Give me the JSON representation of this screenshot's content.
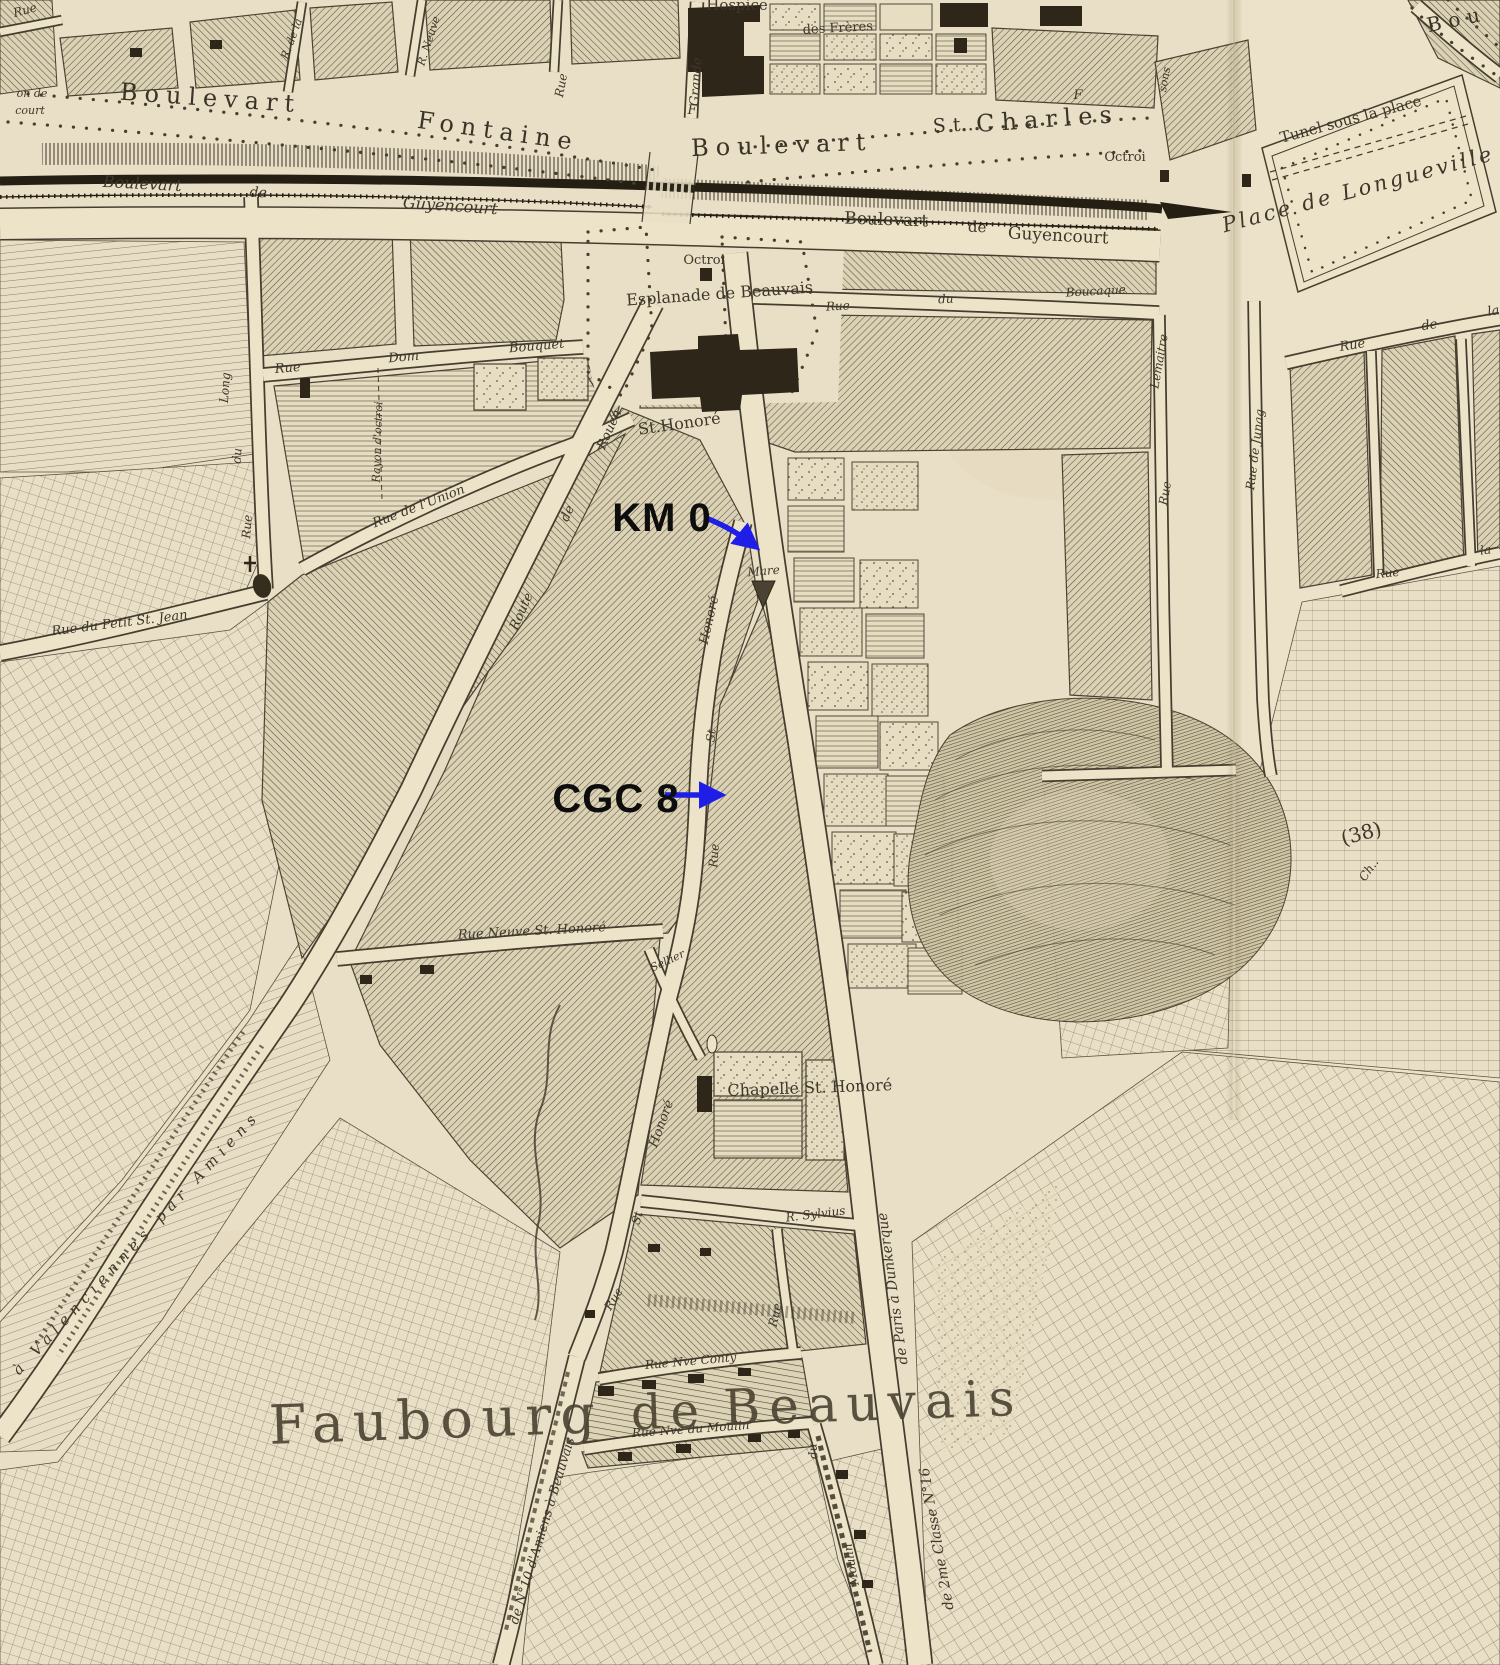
{
  "map": {
    "paper_color": "#e9dfc6",
    "road_color": "#ece3c9",
    "ink_color": "#3e372a",
    "labels": [
      {
        "t": "Boulevart",
        "x": 210,
        "y": 106,
        "r": 4,
        "s": 24,
        "c": "bd"
      },
      {
        "t": "Fontaine",
        "x": 497,
        "y": 139,
        "r": 8,
        "s": 24,
        "c": "bd"
      },
      {
        "t": "Boulevart",
        "x": 782,
        "y": 153,
        "r": -2,
        "s": 24,
        "c": "bd"
      },
      {
        "t": "St.",
        "x": 957,
        "y": 131,
        "r": -3,
        "s": 19,
        "c": "bd"
      },
      {
        "t": "Charles",
        "x": 1048,
        "y": 127,
        "r": -4,
        "s": 24,
        "c": "bd"
      },
      {
        "t": "Boulevart",
        "x": 142,
        "y": 189,
        "r": 3,
        "s": 16
      },
      {
        "t": "de",
        "x": 258,
        "y": 197,
        "r": 3,
        "s": 14
      },
      {
        "t": "Guyencourt",
        "x": 450,
        "y": 211,
        "r": 4,
        "s": 16
      },
      {
        "t": "Boulevart",
        "x": 886,
        "y": 225,
        "r": 2,
        "s": 17,
        "c": "sr"
      },
      {
        "t": "de",
        "x": 977,
        "y": 232,
        "r": 2,
        "s": 15,
        "c": "sr"
      },
      {
        "t": "Guyencourt",
        "x": 1058,
        "y": 241,
        "r": 3,
        "s": 17,
        "c": "sr"
      },
      {
        "t": "Hospice",
        "x": 737,
        "y": 10,
        "r": 0,
        "s": 15,
        "c": "sr"
      },
      {
        "t": "des Frères",
        "x": 838,
        "y": 32,
        "r": -3,
        "s": 13,
        "c": "sr"
      },
      {
        "t": "Grande",
        "x": 700,
        "y": 82,
        "r": -86,
        "s": 13
      },
      {
        "t": "Rue",
        "x": 565,
        "y": 86,
        "r": -80,
        "s": 12
      },
      {
        "t": "R. Neuve",
        "x": 432,
        "y": 42,
        "r": -72,
        "s": 11
      },
      {
        "t": "R. de la",
        "x": 295,
        "y": 40,
        "r": -70,
        "s": 11
      },
      {
        "t": "Rue",
        "x": 26,
        "y": 14,
        "r": -15,
        "s": 12
      },
      {
        "t": "on de",
        "x": 32,
        "y": 97,
        "r": 0,
        "s": 11
      },
      {
        "t": "court",
        "x": 30,
        "y": 114,
        "r": 0,
        "s": 11
      },
      {
        "t": "F",
        "x": 692,
        "y": 114,
        "r": 0,
        "s": 13
      },
      {
        "t": "F",
        "x": 1078,
        "y": 99,
        "r": 0,
        "s": 13
      },
      {
        "t": "Octroi",
        "x": 1125,
        "y": 161,
        "r": 0,
        "s": 13,
        "c": "sr"
      },
      {
        "t": "Tunel sous la place",
        "x": 1352,
        "y": 124,
        "r": -15,
        "s": 15,
        "c": "sr"
      },
      {
        "t": "Place de Longueville",
        "x": 1360,
        "y": 196,
        "r": -15,
        "s": 21,
        "c": "pl"
      },
      {
        "t": "Bou",
        "x": 1458,
        "y": 26,
        "r": -12,
        "s": 20,
        "c": "bd"
      },
      {
        "t": "Rue",
        "x": 1353,
        "y": 349,
        "r": -9,
        "s": 13
      },
      {
        "t": "de",
        "x": 1430,
        "y": 329,
        "r": -9,
        "s": 13
      },
      {
        "t": "la",
        "x": 1494,
        "y": 315,
        "r": -9,
        "s": 13
      },
      {
        "t": "Octroi",
        "x": 704,
        "y": 264,
        "r": 0,
        "s": 13,
        "c": "sr"
      },
      {
        "t": "Esplanade de Beauvais",
        "x": 720,
        "y": 299,
        "r": -4,
        "s": 16,
        "c": "sr"
      },
      {
        "t": "St.Honoré",
        "x": 680,
        "y": 429,
        "r": -8,
        "s": 16,
        "c": "sr"
      },
      {
        "t": "Rue",
        "x": 838,
        "y": 310,
        "r": -3,
        "s": 12
      },
      {
        "t": "du",
        "x": 946,
        "y": 303,
        "r": -3,
        "s": 12
      },
      {
        "t": "Boucaque",
        "x": 1096,
        "y": 295,
        "r": -3,
        "s": 12
      },
      {
        "t": "Lemaitre",
        "x": 1163,
        "y": 362,
        "r": -80,
        "s": 12
      },
      {
        "t": "Rue",
        "x": 1169,
        "y": 494,
        "r": -80,
        "s": 12
      },
      {
        "t": "Rue de Junag",
        "x": 1259,
        "y": 450,
        "r": -83,
        "s": 12
      },
      {
        "t": "Rue",
        "x": 1388,
        "y": 577,
        "r": -6,
        "s": 12
      },
      {
        "t": "la",
        "x": 1486,
        "y": 554,
        "r": -6,
        "s": 12
      },
      {
        "t": "sons",
        "x": 1168,
        "y": 80,
        "r": -80,
        "s": 11
      },
      {
        "t": "Mare",
        "x": 764,
        "y": 575,
        "r": -5,
        "s": 12
      },
      {
        "t": "Honoré",
        "x": 713,
        "y": 621,
        "r": -77,
        "s": 13
      },
      {
        "t": "St",
        "x": 715,
        "y": 736,
        "r": -84,
        "s": 12
      },
      {
        "t": "Rue",
        "x": 718,
        "y": 856,
        "r": -86,
        "s": 12
      },
      {
        "t": "Rouen",
        "x": 613,
        "y": 431,
        "r": -66,
        "s": 13
      },
      {
        "t": "de",
        "x": 571,
        "y": 515,
        "r": -66,
        "s": 13
      },
      {
        "t": "Route",
        "x": 525,
        "y": 613,
        "r": -66,
        "s": 13
      },
      {
        "t": "Rue",
        "x": 288,
        "y": 372,
        "r": -5,
        "s": 13
      },
      {
        "t": "Dom",
        "x": 404,
        "y": 361,
        "r": -5,
        "s": 13
      },
      {
        "t": "Bouquet",
        "x": 537,
        "y": 350,
        "r": -5,
        "s": 13
      },
      {
        "t": "Long",
        "x": 229,
        "y": 388,
        "r": -86,
        "s": 12
      },
      {
        "t": "du",
        "x": 241,
        "y": 456,
        "r": -86,
        "s": 12
      },
      {
        "t": "Rue",
        "x": 251,
        "y": 527,
        "r": -86,
        "s": 12
      },
      {
        "t": "Rayon d'octroi",
        "x": 381,
        "y": 442,
        "r": -88,
        "s": 11
      },
      {
        "t": "Rue de l'Union",
        "x": 420,
        "y": 510,
        "r": -21,
        "s": 13
      },
      {
        "t": "Rue du Petit St. Jean",
        "x": 120,
        "y": 627,
        "r": -7,
        "s": 13
      },
      {
        "t": "Rue Neuve St. Honoré",
        "x": 532,
        "y": 935,
        "r": -3,
        "s": 13
      },
      {
        "t": "Sellier",
        "x": 669,
        "y": 964,
        "r": -25,
        "s": 11
      },
      {
        "t": "Chapelle St. Honoré",
        "x": 810,
        "y": 1093,
        "r": -2,
        "s": 16,
        "c": "sr"
      },
      {
        "t": "R. Sylvius",
        "x": 816,
        "y": 1218,
        "r": -7,
        "s": 12
      },
      {
        "t": "Rue",
        "x": 779,
        "y": 1316,
        "r": -77,
        "s": 12
      },
      {
        "t": "Honoré",
        "x": 665,
        "y": 1125,
        "r": -70,
        "s": 13
      },
      {
        "t": "St",
        "x": 641,
        "y": 1219,
        "r": -74,
        "s": 12
      },
      {
        "t": "Rue",
        "x": 617,
        "y": 1301,
        "r": -58,
        "s": 12
      },
      {
        "t": "Rue Nve Conty",
        "x": 691,
        "y": 1365,
        "r": -5,
        "s": 12
      },
      {
        "t": "Rue Nve du Moulin",
        "x": 691,
        "y": 1433,
        "r": -4,
        "s": 12
      },
      {
        "t": "du",
        "x": 817,
        "y": 1451,
        "r": -95,
        "s": 12
      },
      {
        "t": "Moulin",
        "x": 855,
        "y": 1564,
        "r": -100,
        "s": 12
      },
      {
        "t": "de N°10 d'Amiens à Beauvais",
        "x": 546,
        "y": 1532,
        "r": -73,
        "s": 13
      },
      {
        "t": "à  Valenciennes  par  Amiens",
        "x": 140,
        "y": 1246,
        "r": -47,
        "s": 15,
        "c": "sp"
      },
      {
        "t": "de Paris à Dunkerque",
        "x": 897,
        "y": 1288,
        "r": -98,
        "s": 14
      },
      {
        "t": "de 2me Classe N°16",
        "x": 941,
        "y": 1538,
        "r": -100,
        "s": 14
      },
      {
        "t": "(38)",
        "x": 1363,
        "y": 840,
        "r": -15,
        "s": 20,
        "c": "sr"
      },
      {
        "t": "Ch..",
        "x": 1372,
        "y": 872,
        "r": -55,
        "s": 12
      },
      {
        "t": "Faubourg",
        "x": 437,
        "y": 1438,
        "r": -2,
        "s": 54,
        "c": "big"
      },
      {
        "t": "de",
        "x": 670,
        "y": 1428,
        "r": -2,
        "s": 48,
        "c": "big"
      },
      {
        "t": "Beauvais",
        "x": 874,
        "y": 1420,
        "r": -2,
        "s": 50,
        "c": "big"
      }
    ]
  },
  "annotations": {
    "arrow_color": "#1e1ee8",
    "text_color": "#0d0d0d",
    "items": [
      {
        "id": "km-0",
        "label": "KM 0",
        "x": 662,
        "y": 531,
        "size": 40,
        "arrow_d": "M706,518 Q734,529 756,547"
      },
      {
        "id": "cgc-8",
        "label": "CGC 8",
        "x": 616,
        "y": 812,
        "size": 40,
        "arrow_d": "M665,795 L721,795"
      }
    ]
  }
}
